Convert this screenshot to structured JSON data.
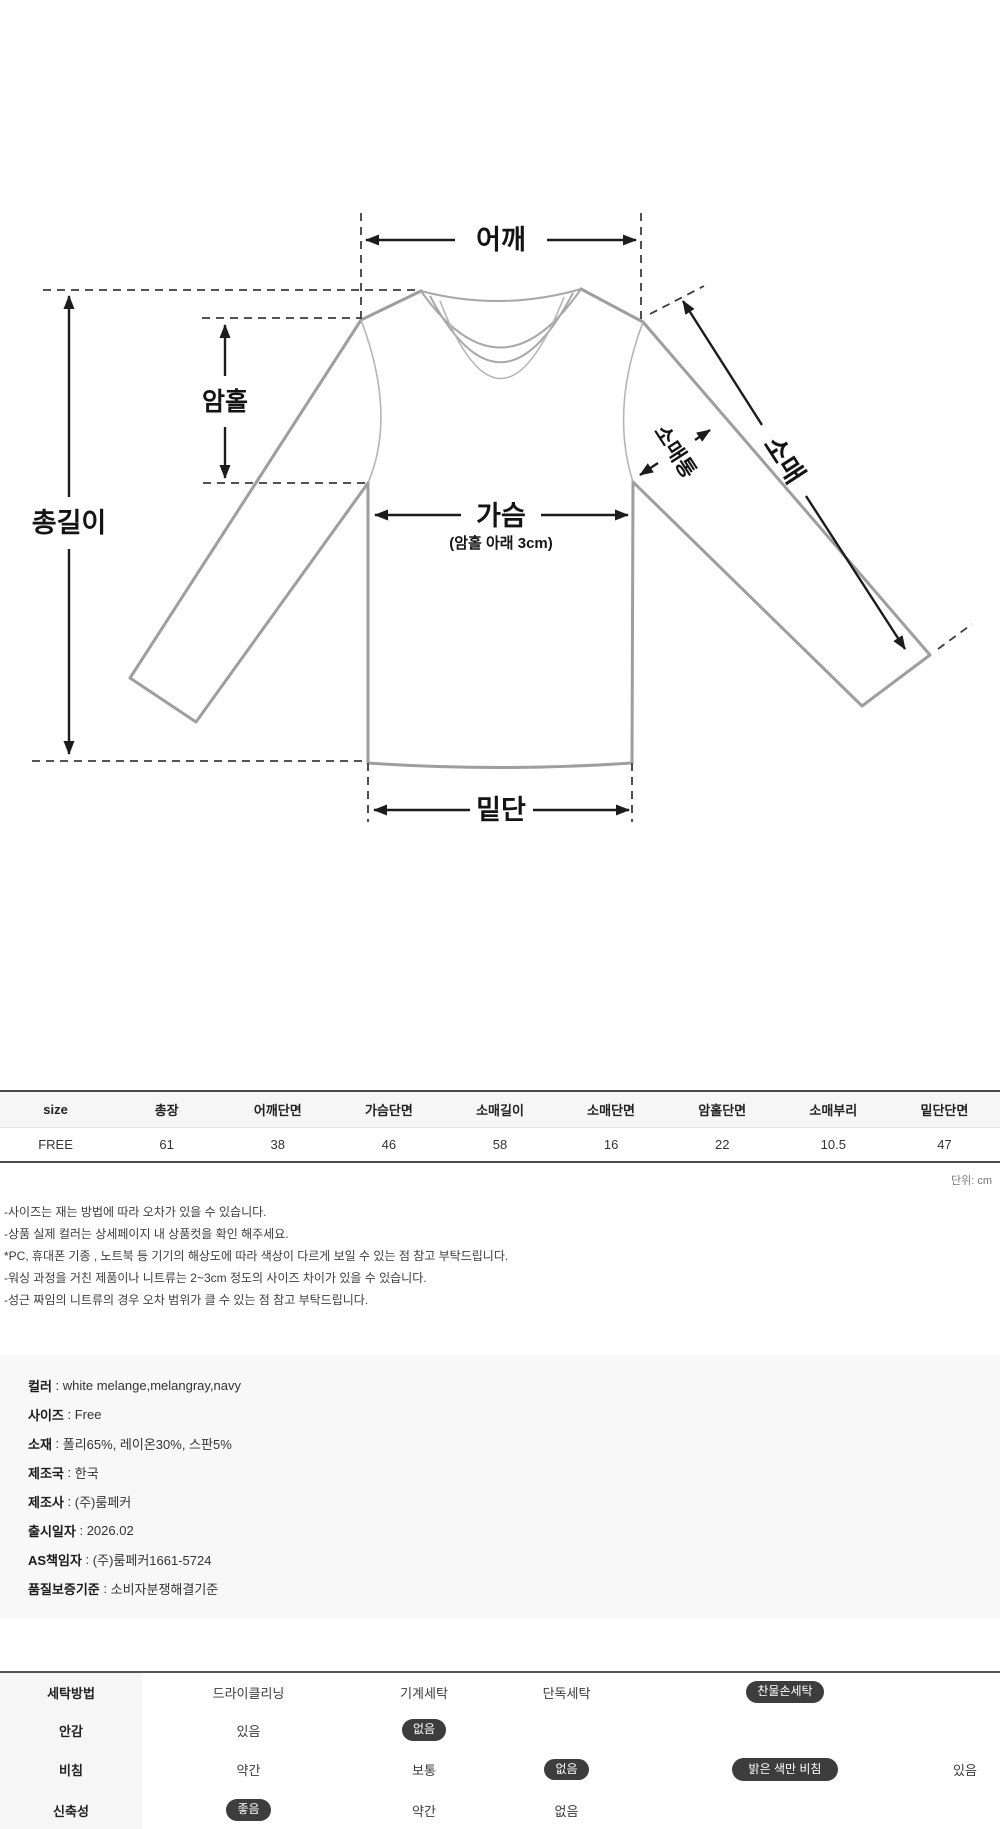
{
  "colon": " : ",
  "diagram": {
    "labels": {
      "shoulder": "어깨",
      "total_length": "총길이",
      "armhole": "암홀",
      "chest": "가슴",
      "chest_note": "(암홀 아래 3cm)",
      "sleeve": "소매",
      "sleeve_width": "소매통",
      "hem": "밑단"
    }
  },
  "size_table": {
    "headers": [
      "size",
      "총장",
      "어깨단면",
      "가슴단면",
      "소매길이",
      "소매단면",
      "암홀단면",
      "소매부리",
      "밑단단면"
    ],
    "rows": [
      [
        "FREE",
        "61",
        "38",
        "46",
        "58",
        "16",
        "22",
        "10.5",
        "47"
      ]
    ],
    "unit_note": "단위: cm"
  },
  "notes": [
    "-사이즈는 재는 방법에 따라 오차가 있을 수 있습니다.",
    "-상품 실제 컬러는 상세페이지 내 상품컷을 확인 해주세요.",
    "*PC, 휴대폰 기종 , 노트북 등 기기의 해상도에 따라 색상이 다르게 보일 수 있는 점 참고 부탁드립니다.",
    "-워싱 과정을 거친 제품이나 니트류는 2~3cm 정도의 사이즈 차이가 있을 수 있습니다.",
    "-성근 짜임의 니트류의 경우 오차 범위가 클 수 있는 점 참고 부탁드립니다."
  ],
  "product_info": [
    {
      "label": "컬러",
      "value": "white melange,melangray,navy"
    },
    {
      "label": "사이즈",
      "value": "Free"
    },
    {
      "label": "소재",
      "value": "폴리65%, 레이온30%, 스판5%"
    },
    {
      "label": "제조국",
      "value": "한국"
    },
    {
      "label": "제조사",
      "value": "(주)룸페커"
    },
    {
      "label": "출시일자",
      "value": "2026.02"
    },
    {
      "label": "AS책임자",
      "value": "(주)룸페커1661-5724"
    },
    {
      "label": "품질보증기준",
      "value": "소비자분쟁해결기준"
    }
  ],
  "care_table": {
    "rows": [
      {
        "label": "세탁방법",
        "options": [
          {
            "text": "드라이클리닝",
            "selected": false
          },
          {
            "text": "기계세탁",
            "selected": false
          },
          {
            "text": "단독세탁",
            "selected": false
          },
          {
            "text": "찬물손세탁",
            "selected": true
          }
        ]
      },
      {
        "label": "안감",
        "options": [
          {
            "text": "있음",
            "selected": false
          },
          {
            "text": "없음",
            "selected": true
          }
        ]
      },
      {
        "label": "비침",
        "options": [
          {
            "text": "약간",
            "selected": false
          },
          {
            "text": "보통",
            "selected": false
          },
          {
            "text": "없음",
            "selected": true
          },
          {
            "text": "밝은 색만 비침",
            "selected": true
          },
          {
            "text": "있음",
            "selected": false
          }
        ]
      },
      {
        "label": "신축성",
        "options": [
          {
            "text": "좋음",
            "selected": true
          },
          {
            "text": "약간",
            "selected": false
          },
          {
            "text": "없음",
            "selected": false
          }
        ]
      }
    ]
  },
  "style_colors": {
    "pill_bg": "#3d3d3d",
    "table_border": "#4a4a4a",
    "section_bg": "#f8f8f8",
    "shirt_outline": "#9e9e9e"
  }
}
